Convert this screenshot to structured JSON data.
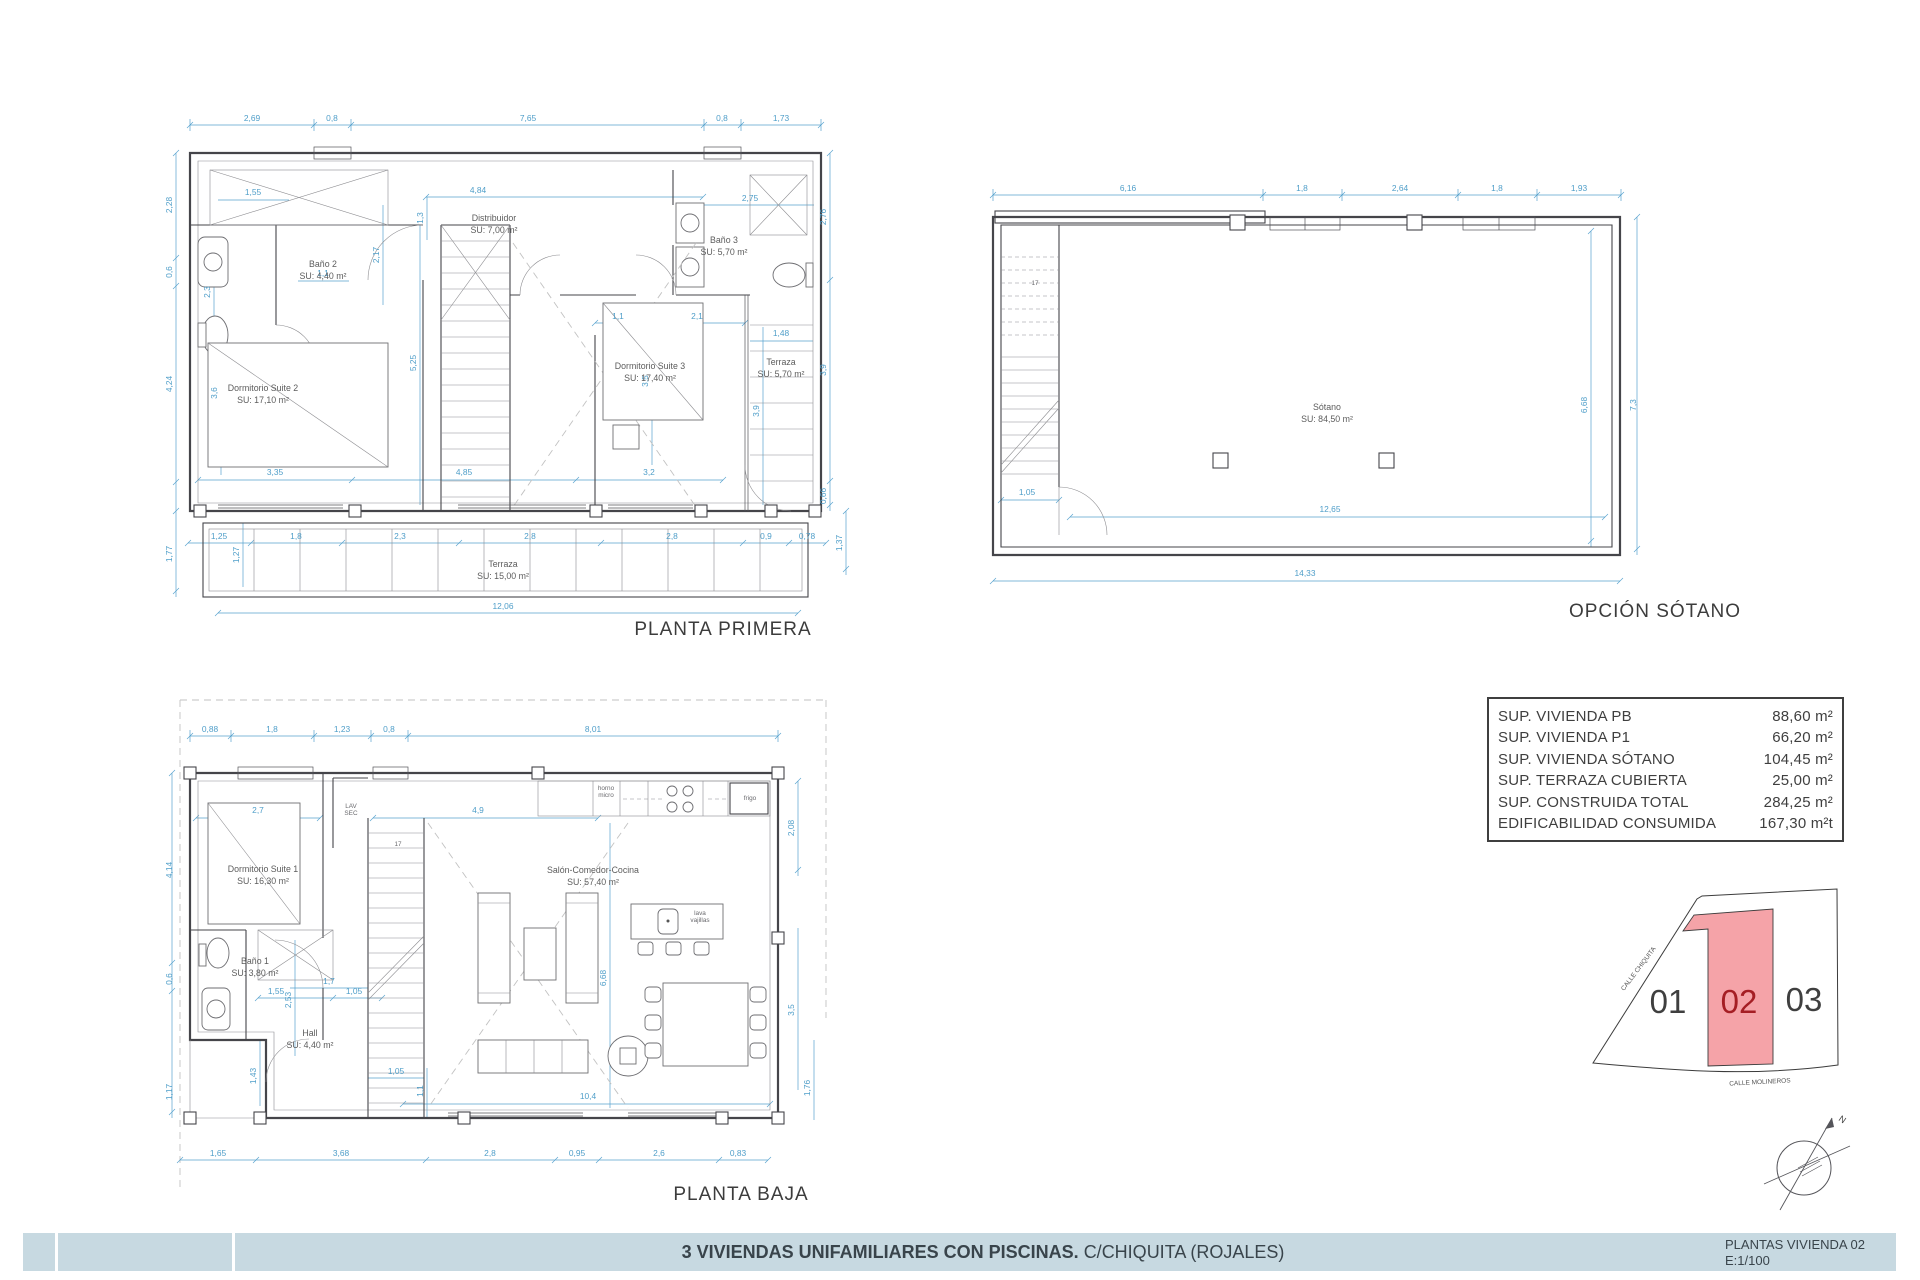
{
  "footer": {
    "title_bold": "3 VIVIENDAS UNIFAMILIARES CON PISCINAS.",
    "title_regular": "C/CHIQUITA (ROJALES)",
    "sheet_name": "PLANTAS VIVIENDA 02",
    "scale_label": "E:1/100",
    "bar_color": "#c7d9e1"
  },
  "area_table": {
    "rows": [
      {
        "label": "SUP. VIVIENDA PB",
        "value": "88,60 m²"
      },
      {
        "label": "SUP. VIVIENDA P1",
        "value": "66,20 m²"
      },
      {
        "label": "SUP. VIVIENDA SÓTANO",
        "value": "104,45 m²"
      },
      {
        "label": "SUP. TERRAZA CUBIERTA",
        "value": "25,00 m²"
      },
      {
        "label": "SUP. CONSTRUIDA TOTAL",
        "value": "284,25 m²"
      },
      {
        "label": "EDIFICABILIDAD CONSUMIDA",
        "value": "167,30 m²t"
      }
    ]
  },
  "site_plan": {
    "plot_ids": [
      "01",
      "02",
      "03"
    ],
    "street_left": "CALLE CHIQUITA",
    "street_bottom": "CALLE MOLINEROS",
    "north": "N",
    "highlight_fill": "#f5a3a8",
    "highlight_text": "#a51e24"
  },
  "plans": {
    "primera": {
      "title": "PLANTA PRIMERA",
      "rooms": [
        {
          "x": 165,
          "y": 192,
          "lines": [
            "Baño 2",
            "SU: 4,40 m²"
          ]
        },
        {
          "x": 336,
          "y": 146,
          "lines": [
            "Distribuidor",
            "SU: 7,00 m²"
          ]
        },
        {
          "x": 566,
          "y": 168,
          "lines": [
            "Baño 3",
            "SU: 5,70 m²"
          ]
        },
        {
          "x": 105,
          "y": 316,
          "lines": [
            "Dormitorio Suite 2",
            "SU: 17,10 m²"
          ]
        },
        {
          "x": 492,
          "y": 294,
          "lines": [
            "Dormitorio Suite 3",
            "SU: 17,40 m²"
          ]
        },
        {
          "x": 623,
          "y": 290,
          "lines": [
            "Terraza",
            "SU: 5,70 m²"
          ]
        },
        {
          "x": 345,
          "y": 492,
          "lines": [
            "Terraza",
            "SU: 15,00 m²"
          ]
        }
      ],
      "dims": [
        {
          "v": "2,69",
          "x": 94,
          "y": 46
        },
        {
          "v": "0,8",
          "x": 174,
          "y": 46
        },
        {
          "v": "7,65",
          "x": 370,
          "y": 46
        },
        {
          "v": "0,8",
          "x": 564,
          "y": 46
        },
        {
          "v": "1,73",
          "x": 623,
          "y": 46
        },
        {
          "v": "1,55",
          "x": 95,
          "y": 120
        },
        {
          "v": "4,84",
          "x": 320,
          "y": 118
        },
        {
          "v": "2,75",
          "x": 592,
          "y": 126
        },
        {
          "v": "1,3",
          "x": 265,
          "y": 143,
          "r": 1
        },
        {
          "v": "2,17",
          "x": 221,
          "y": 180,
          "r": 1
        },
        {
          "v": "2,3",
          "x": 52,
          "y": 217,
          "r": 1
        },
        {
          "v": "1,1",
          "x": 165,
          "y": 201
        },
        {
          "v": "1,1",
          "x": 460,
          "y": 244
        },
        {
          "v": "2,1",
          "x": 539,
          "y": 244
        },
        {
          "v": "1,48",
          "x": 623,
          "y": 261
        },
        {
          "v": "5,25",
          "x": 258,
          "y": 288,
          "r": 1
        },
        {
          "v": "3,6",
          "x": 59,
          "y": 318,
          "r": 1
        },
        {
          "v": "3,5",
          "x": 490,
          "y": 306,
          "r": 1
        },
        {
          "v": "3,9",
          "x": 601,
          "y": 336,
          "r": 1
        },
        {
          "v": "3,35",
          "x": 117,
          "y": 400
        },
        {
          "v": "4,85",
          "x": 306,
          "y": 400
        },
        {
          "v": "3,2",
          "x": 491,
          "y": 400
        },
        {
          "v": "2,28",
          "x": 14,
          "y": 130,
          "r": 1
        },
        {
          "v": "0,6",
          "x": 14,
          "y": 197,
          "r": 1
        },
        {
          "v": "4,24",
          "x": 14,
          "y": 309,
          "r": 1
        },
        {
          "v": "1,77",
          "x": 14,
          "y": 479,
          "r": 1
        },
        {
          "v": "1,27",
          "x": 81,
          "y": 480,
          "r": 1
        },
        {
          "v": "2,76",
          "x": 668,
          "y": 142,
          "r": 1
        },
        {
          "v": "3,9",
          "x": 668,
          "y": 295,
          "r": 1
        },
        {
          "v": "0,66",
          "x": 668,
          "y": 421,
          "r": 1
        },
        {
          "v": "1,37",
          "x": 684,
          "y": 468,
          "r": 1
        },
        {
          "v": "1,25",
          "x": 61,
          "y": 464
        },
        {
          "v": "1,8",
          "x": 138,
          "y": 464
        },
        {
          "v": "2,3",
          "x": 242,
          "y": 464
        },
        {
          "v": "2,8",
          "x": 372,
          "y": 464
        },
        {
          "v": "2,8",
          "x": 514,
          "y": 464
        },
        {
          "v": "0,9",
          "x": 608,
          "y": 464
        },
        {
          "v": "0,78",
          "x": 649,
          "y": 464
        },
        {
          "v": "12,06",
          "x": 345,
          "y": 534
        }
      ]
    },
    "sotano": {
      "title": "OPCIÓN SÓTANO",
      "rooms": [
        {
          "x": 352,
          "y": 245,
          "lines": [
            "Sótano",
            "SU: 84,50 m²"
          ]
        }
      ],
      "small": [
        {
          "x": 60,
          "y": 120,
          "lines": [
            "17"
          ]
        }
      ],
      "dims": [
        {
          "v": "6,16",
          "x": 153,
          "y": 26
        },
        {
          "v": "1,8",
          "x": 327,
          "y": 26
        },
        {
          "v": "2,64",
          "x": 425,
          "y": 26
        },
        {
          "v": "1,8",
          "x": 522,
          "y": 26
        },
        {
          "v": "1,93",
          "x": 604,
          "y": 26
        },
        {
          "v": "1,05",
          "x": 52,
          "y": 330
        },
        {
          "v": "12,65",
          "x": 355,
          "y": 347
        },
        {
          "v": "6,68",
          "x": 612,
          "y": 240,
          "r": 1
        },
        {
          "v": "7,3",
          "x": 661,
          "y": 240,
          "r": 1
        },
        {
          "v": "14,33",
          "x": 330,
          "y": 411
        }
      ]
    },
    "baja": {
      "title": "PLANTA BAJA",
      "rooms": [
        {
          "x": 105,
          "y": 184,
          "lines": [
            "Dormitorio Suite 1",
            "SU: 16,30 m²"
          ]
        },
        {
          "x": 435,
          "y": 185,
          "lines": [
            "Salón-Comedor-Cocina",
            "SU: 57,40 m²"
          ]
        },
        {
          "x": 97,
          "y": 276,
          "lines": [
            "Baño 1",
            "SU: 3,80 m²"
          ]
        },
        {
          "x": 152,
          "y": 348,
          "lines": [
            "Hall",
            "SU: 4,40 m²"
          ]
        }
      ],
      "small": [
        {
          "x": 193,
          "y": 120,
          "lines": [
            "LAV",
            "SEC"
          ]
        },
        {
          "x": 240,
          "y": 158,
          "lines": [
            "17"
          ]
        },
        {
          "x": 448,
          "y": 102,
          "lines": [
            "horno",
            "micro"
          ]
        },
        {
          "x": 592,
          "y": 112,
          "lines": [
            "frigo"
          ]
        },
        {
          "x": 542,
          "y": 227,
          "lines": [
            "lava",
            "vajillas"
          ]
        }
      ],
      "dims": [
        {
          "v": "0,88",
          "x": 52,
          "y": 44
        },
        {
          "v": "1,8",
          "x": 114,
          "y": 44
        },
        {
          "v": "1,23",
          "x": 184,
          "y": 44
        },
        {
          "v": "0,8",
          "x": 231,
          "y": 44
        },
        {
          "v": "8,01",
          "x": 435,
          "y": 44
        },
        {
          "v": "2,7",
          "x": 100,
          "y": 125
        },
        {
          "v": "4,9",
          "x": 320,
          "y": 125
        },
        {
          "v": "2,08",
          "x": 636,
          "y": 140,
          "r": 1
        },
        {
          "v": "3,5",
          "x": 636,
          "y": 322,
          "r": 1
        },
        {
          "v": "1,76",
          "x": 652,
          "y": 400,
          "r": 1
        },
        {
          "v": "4,14",
          "x": 14,
          "y": 182,
          "r": 1
        },
        {
          "v": "0,6",
          "x": 14,
          "y": 291,
          "r": 1
        },
        {
          "v": "1,17",
          "x": 14,
          "y": 404,
          "r": 1
        },
        {
          "v": "6,68",
          "x": 448,
          "y": 290,
          "r": 1
        },
        {
          "v": "1,55",
          "x": 118,
          "y": 306
        },
        {
          "v": "1,05",
          "x": 196,
          "y": 306
        },
        {
          "v": "1,7",
          "x": 171,
          "y": 296
        },
        {
          "v": "2,53",
          "x": 133,
          "y": 312,
          "r": 1
        },
        {
          "v": "1,43",
          "x": 98,
          "y": 388,
          "r": 1
        },
        {
          "v": "1,05",
          "x": 238,
          "y": 386
        },
        {
          "v": "1,1",
          "x": 265,
          "y": 403,
          "r": 1
        },
        {
          "v": "10,4",
          "x": 430,
          "y": 411
        },
        {
          "v": "1,65",
          "x": 60,
          "y": 468
        },
        {
          "v": "3,68",
          "x": 183,
          "y": 468
        },
        {
          "v": "2,8",
          "x": 332,
          "y": 468
        },
        {
          "v": "0,95",
          "x": 419,
          "y": 468
        },
        {
          "v": "2,6",
          "x": 501,
          "y": 468
        },
        {
          "v": "0,83",
          "x": 580,
          "y": 468
        }
      ]
    }
  }
}
